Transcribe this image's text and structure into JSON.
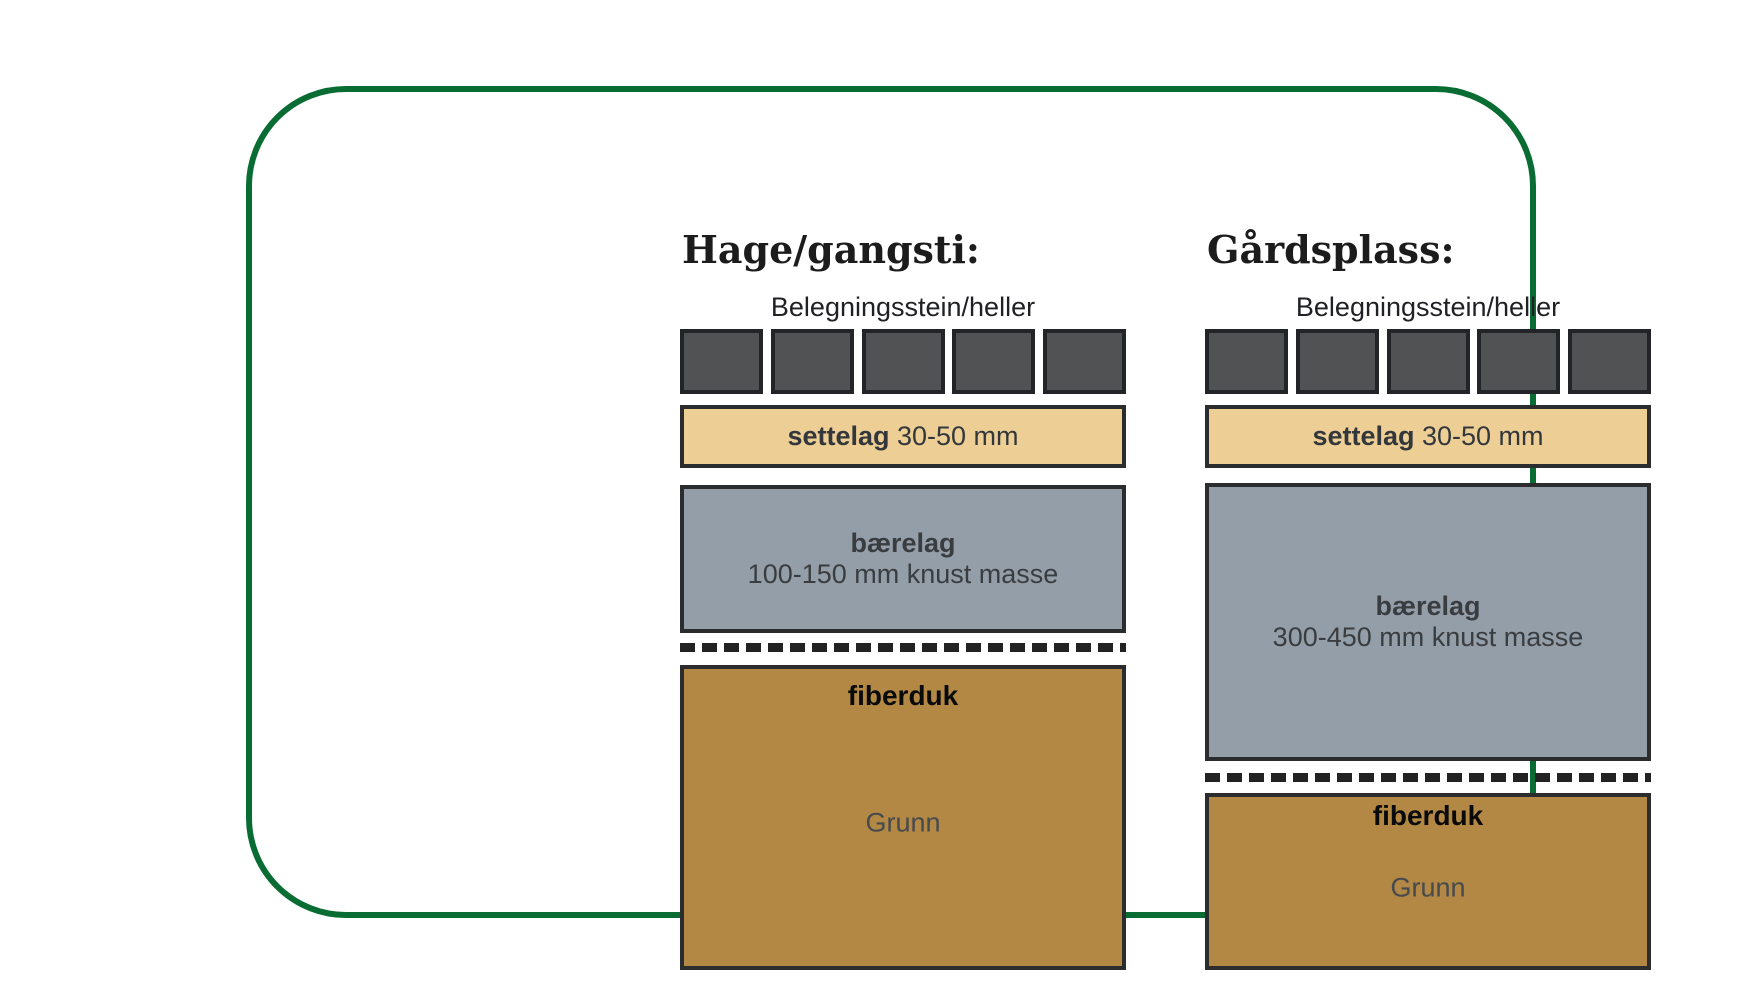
{
  "diagram": {
    "description_colors": {
      "frame_green": "#096c33",
      "paver_dark_gray": "#515254",
      "settelag_tan": "#edcf96",
      "baerelag_blue_gray": "#939ea9",
      "grunn_brown": "#b28844",
      "outline_dark": "#2b2c2e"
    },
    "columns": [
      {
        "title": "Hage/gangsti:",
        "paver_label": "Belegningsstein/heller",
        "paver_count": 5,
        "settelag_bold": "settelag",
        "settelag_rest": " 30-50 mm",
        "baerelag_bold": "bærelag",
        "baerelag_detail": "100-150 mm knust masse",
        "fiberduk_label": "fiberduk",
        "grunn_label": "Grunn"
      },
      {
        "title": "Gårdsplass:",
        "paver_label": "Belegningsstein/heller",
        "paver_count": 5,
        "settelag_bold": "settelag",
        "settelag_rest": " 30-50 mm",
        "baerelag_bold": "bærelag",
        "baerelag_detail": "300-450 mm knust masse",
        "fiberduk_label": "fiberduk",
        "grunn_label": "Grunn"
      }
    ]
  }
}
